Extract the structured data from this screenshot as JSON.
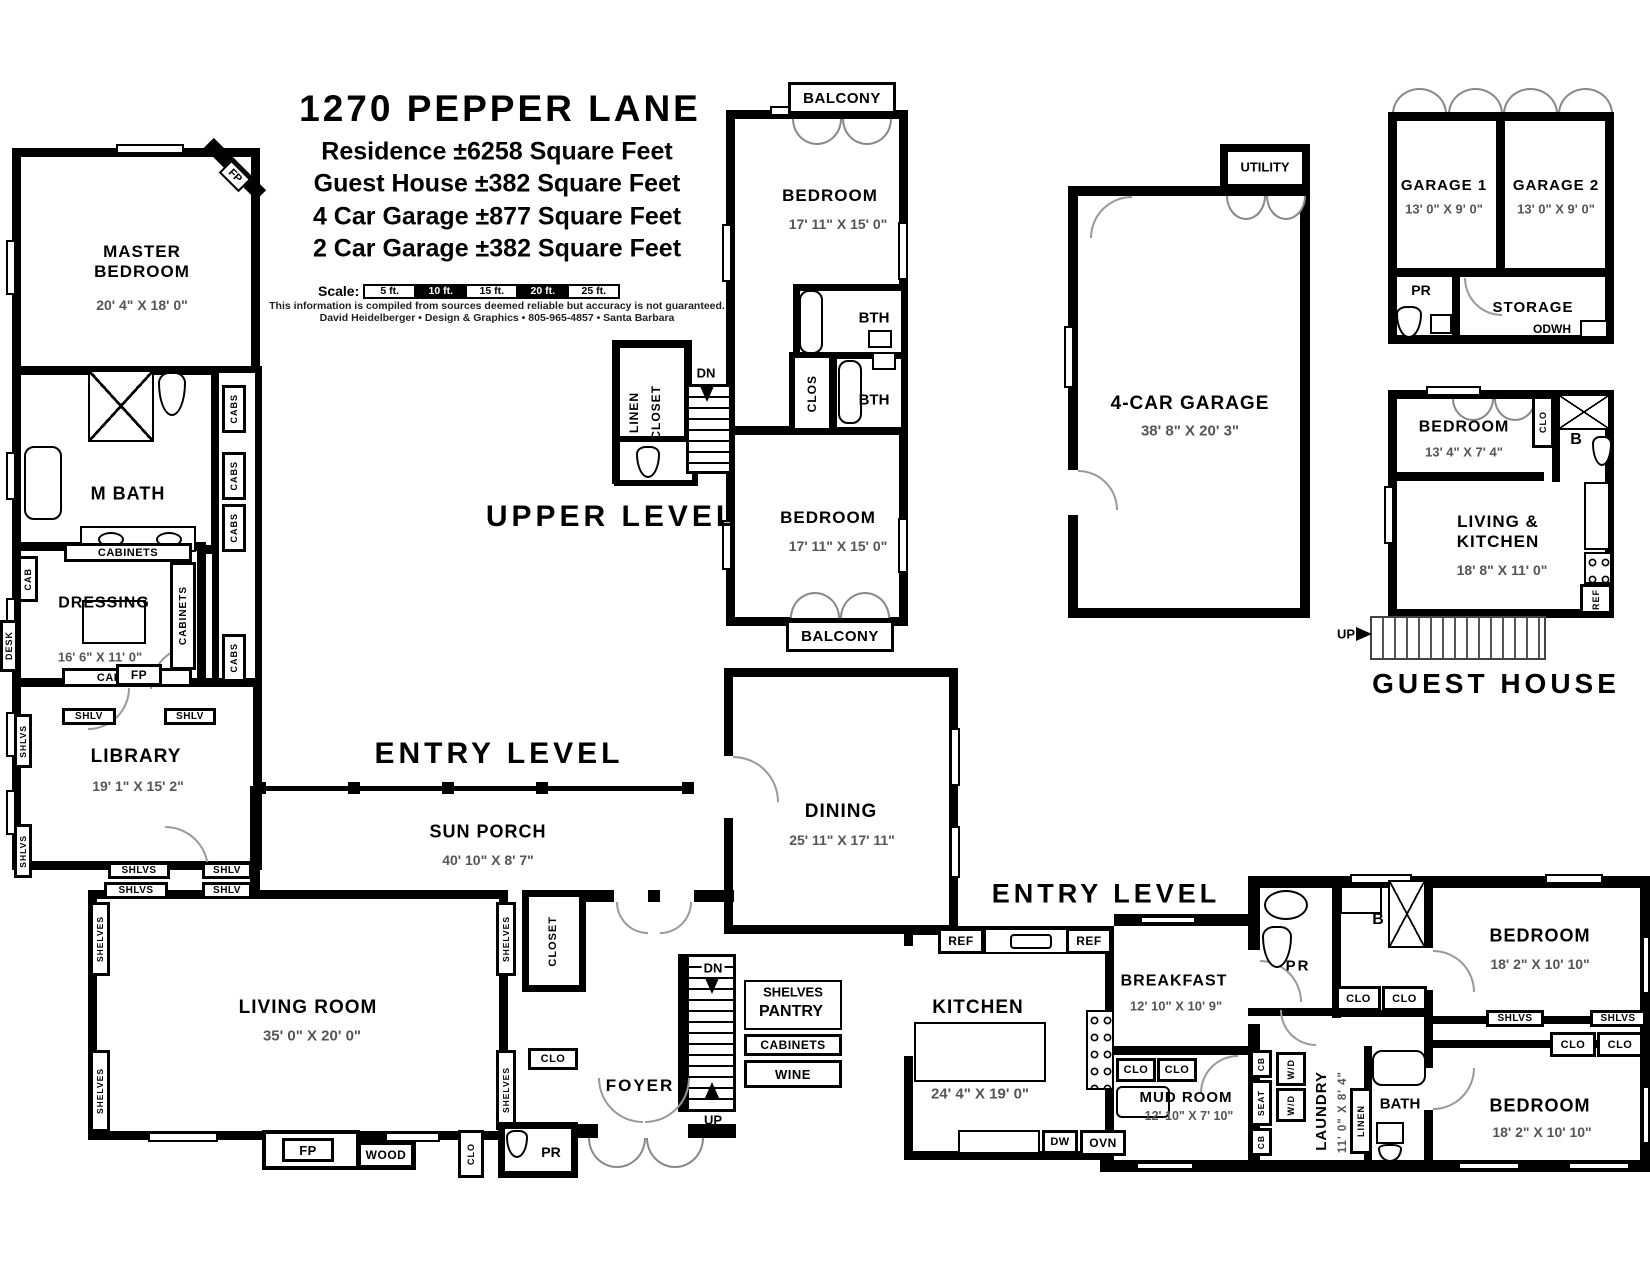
{
  "title_block": {
    "title": "1270 PEPPER LANE",
    "line1": "Residence ±6258 Square Feet",
    "line2": "Guest House ±382 Square Feet",
    "line3": "4 Car Garage ±877 Square Feet",
    "line4": "2 Car Garage ±382 Square Feet",
    "scale_label": "Scale:",
    "scale_segments": [
      "5 ft.",
      "10 ft.",
      "15 ft.",
      "20 ft.",
      "25 ft."
    ],
    "disclaimer": "This information is compiled from sources deemed reliable but accuracy is not guaranteed.",
    "credit": "David Heidelberger • Design & Graphics • 805-965-4857 • Santa Barbara"
  },
  "level_labels": {
    "upper": "UPPER LEVEL",
    "entry": "ENTRY LEVEL",
    "guest_house": "GUEST HOUSE"
  },
  "rooms": {
    "master_bedroom": {
      "name": "MASTER\nBEDROOM",
      "dims": "20' 4\" X 18' 0\""
    },
    "m_bath": {
      "name": "M BATH"
    },
    "dressing": {
      "name": "DRESSING",
      "dims": "16' 6\" X 11' 0\""
    },
    "library": {
      "name": "LIBRARY",
      "dims": "19' 1\" X 15' 2\""
    },
    "bedroom_upper_1": {
      "name": "BEDROOM",
      "dims": "17' 11\" X 15' 0\""
    },
    "bedroom_upper_2": {
      "name": "BEDROOM",
      "dims": "17' 11\" X 15' 0\""
    },
    "four_car_garage": {
      "name": "4-CAR GARAGE",
      "dims": "38' 8\" X 20' 3\""
    },
    "utility": {
      "name": "UTILITY"
    },
    "garage_1": {
      "name": "GARAGE 1",
      "dims": "13' 0\" X 9' 0\""
    },
    "garage_2": {
      "name": "GARAGE 2",
      "dims": "13' 0\" X 9' 0\""
    },
    "storage": {
      "name": "STORAGE"
    },
    "guest_bedroom": {
      "name": "BEDROOM",
      "dims": "13' 4\" X 7' 4\""
    },
    "living_kitchen": {
      "name": "LIVING &\nKITCHEN",
      "dims": "18' 8\" X 11' 0\""
    },
    "sun_porch": {
      "name": "SUN PORCH",
      "dims": "40' 10\" X 8' 7\""
    },
    "dining": {
      "name": "DINING",
      "dims": "25' 11\" X 17' 11\""
    },
    "living_room": {
      "name": "LIVING ROOM",
      "dims": "35' 0\" X 20' 0\""
    },
    "foyer": {
      "name": "FOYER"
    },
    "kitchen": {
      "name": "KITCHEN",
      "dims": "24' 4\" X 19' 0\""
    },
    "breakfast": {
      "name": "BREAKFAST",
      "dims": "12' 10\" X 10' 9\""
    },
    "mud_room": {
      "name": "MUD ROOM",
      "dims": "12' 10\" X 7' 10\""
    },
    "laundry": {
      "name": "LAUNDRY",
      "dims": "11' 0\" X 8' 4\""
    },
    "bath": {
      "name": "BATH"
    },
    "bedroom_east_1": {
      "name": "BEDROOM",
      "dims": "18' 2\" X 10' 10\""
    },
    "bedroom_east_2": {
      "name": "BEDROOM",
      "dims": "18' 2\" X 10' 10\""
    },
    "pantry": {
      "name": "PANTRY",
      "shelves": "SHELVES"
    }
  },
  "labels": {
    "balcony": "BALCONY",
    "bth": "BTH",
    "clos": "CLOS",
    "clo": "CLO",
    "cab": "CAB",
    "cabs": "CABS",
    "cabinets": "CABINETS",
    "shlv": "SHLV",
    "shlvs": "SHLVS",
    "shelves": "SHELVES",
    "desk": "DESK",
    "fp": "FP",
    "pr": "PR",
    "b": "B",
    "ref": "REF",
    "dn": "DN",
    "up": "UP",
    "wood": "WOOD",
    "wine": "WINE",
    "dw": "DW",
    "ovn": "OVN",
    "odwh": "ODWH",
    "wd": "W/D",
    "cb": "CB",
    "seat": "SEAT",
    "linen": "LINEN",
    "closet": "CLOSET"
  }
}
